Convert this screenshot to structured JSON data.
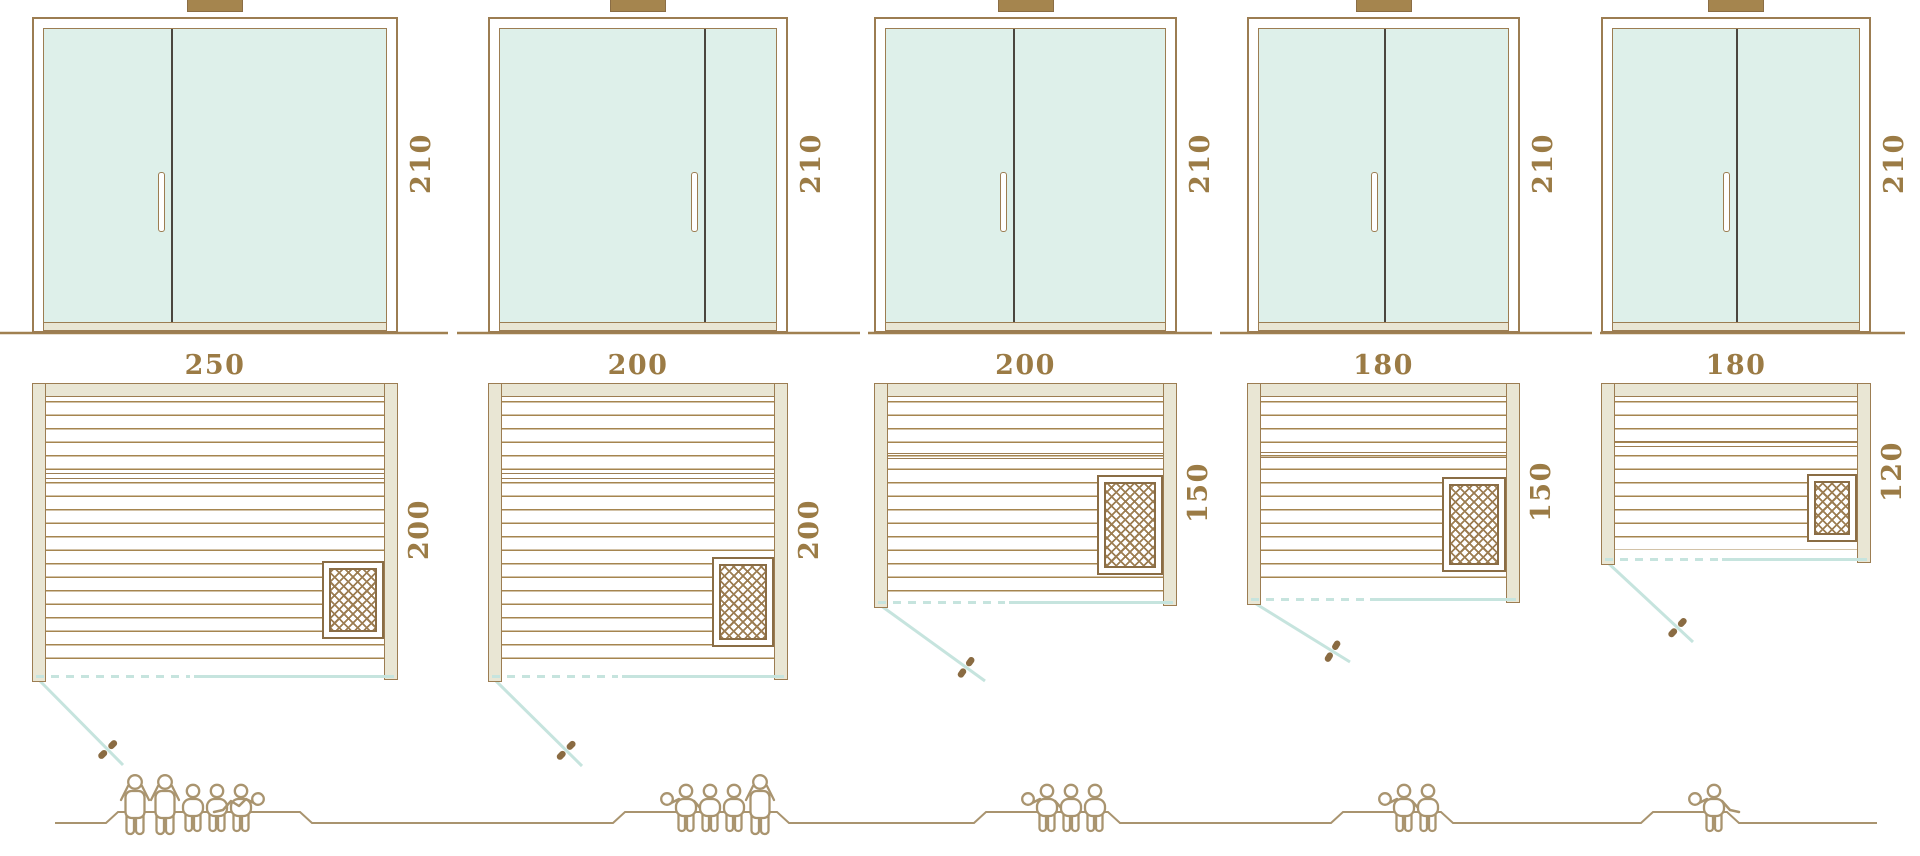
{
  "diagram": {
    "description": "Sauna size options: glass door elevations (front view), floor plans with heater, and capacity figures",
    "rows": [
      "door-elevation",
      "floor-plan",
      "capacity-figures"
    ]
  },
  "units": [
    {
      "id": "sauna-250x200",
      "width_label": "250",
      "depth_label": "200",
      "height_label": "210",
      "capacity": 6,
      "people": [
        "standing",
        "standing",
        "sitting",
        "sitting",
        "sitting",
        "lying-right"
      ]
    },
    {
      "id": "sauna-200x200",
      "width_label": "200",
      "depth_label": "200",
      "height_label": "210",
      "capacity": 5,
      "people": [
        "lying-left",
        "sitting",
        "sitting",
        "sitting",
        "standing"
      ]
    },
    {
      "id": "sauna-200x150",
      "width_label": "200",
      "depth_label": "150",
      "height_label": "210",
      "capacity": 4,
      "people": [
        "lying-left",
        "sitting",
        "sitting",
        "sitting"
      ]
    },
    {
      "id": "sauna-180x150",
      "width_label": "180",
      "depth_label": "150",
      "height_label": "210",
      "capacity": 3,
      "people": [
        "lying-left",
        "sitting",
        "sitting"
      ]
    },
    {
      "id": "sauna-180x120",
      "width_label": "180",
      "depth_label": "120",
      "height_label": "210",
      "capacity": 2,
      "people": [
        "lying-left",
        "sitting"
      ]
    }
  ],
  "colors": {
    "outline_brown": "#9c7d52",
    "dark_brown": "#8a6d45",
    "beige_wood": "#e9e6d4",
    "glass_mint": "#def0ea",
    "teal_glassline": "#c6e4de",
    "label_text": "#9b7b45",
    "door_divider": "#4a463f",
    "people_outline": "#a9946f"
  }
}
